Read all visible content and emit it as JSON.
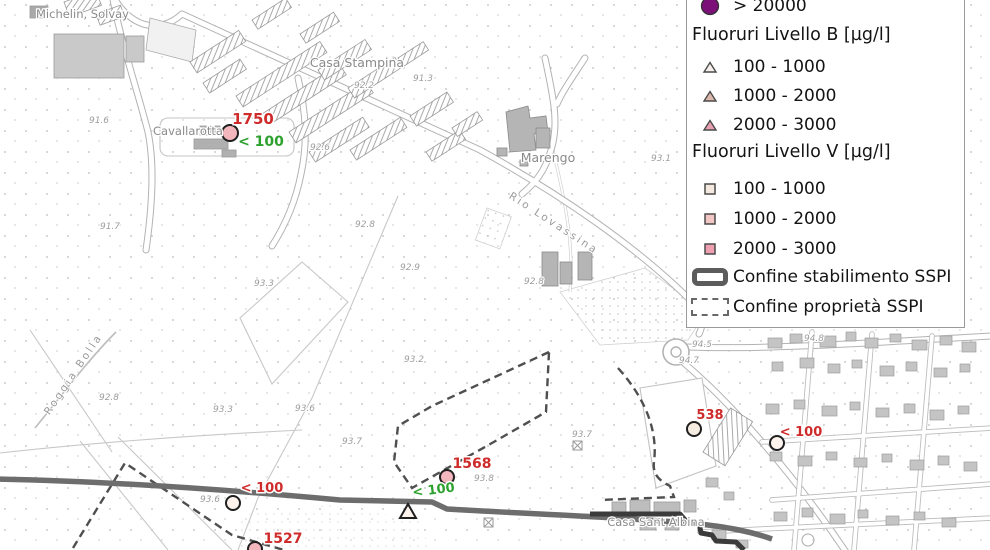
{
  "legend": {
    "top_item": {
      "label": "> 20000",
      "color": "#7a1078"
    },
    "section_b": {
      "title": "Fluoruri Livello B [µg/l]",
      "items": [
        {
          "label": "100 - 1000",
          "color": "#f5eeea"
        },
        {
          "label": "1000 - 2000",
          "color": "#dcb7ac"
        },
        {
          "label": "2000 - 3000",
          "color": "#e7a0b0"
        }
      ]
    },
    "section_v": {
      "title": "Fluoruri Livello V [µg/l]",
      "items": [
        {
          "label": "100 - 1000",
          "color": "#f5e8de"
        },
        {
          "label": "1000 - 2000",
          "color": "#f2c6c2"
        },
        {
          "label": "2000 - 3000",
          "color": "#efa0b0"
        }
      ]
    },
    "boundary_items": [
      {
        "label": "Confine stabilimento SSPI",
        "style": "solid"
      },
      {
        "label": "Confine proprietà SSPI",
        "style": "dashed"
      }
    ]
  },
  "map": {
    "colors": {
      "measurement_red": "#cf2b2b",
      "measurement_green": "#2da12d",
      "marker_pink": "#f2b6bc",
      "marker_light": "#fdf3ec",
      "marker_cream": "#f7ece2"
    },
    "place_labels": [
      {
        "text": "Michelin, Solvay"
      },
      {
        "text": "Casa Stampina"
      },
      {
        "text": "Cavallarotta"
      },
      {
        "text": "Marengo"
      },
      {
        "text": "Casa Sant Albina"
      },
      {
        "text": "Rio Lovassina"
      },
      {
        "text": "Roggia Bolla"
      }
    ],
    "elevations": [
      {
        "t": "91.6"
      },
      {
        "t": "92.2"
      },
      {
        "t": "91.3"
      },
      {
        "t": "92.6"
      },
      {
        "t": "91.7"
      },
      {
        "t": "92.8"
      },
      {
        "t": "92.9"
      },
      {
        "t": "93.3"
      },
      {
        "t": "92.8"
      },
      {
        "t": "93.1"
      },
      {
        "t": "93.2"
      },
      {
        "t": "93.3"
      },
      {
        "t": "93.6"
      },
      {
        "t": "92.8"
      },
      {
        "t": "93.7"
      },
      {
        "t": "93.6"
      },
      {
        "t": "93.7"
      },
      {
        "t": "93.8"
      },
      {
        "t": "94.5"
      },
      {
        "t": "94.7"
      },
      {
        "t": "94.8"
      }
    ],
    "measurements": [
      {
        "value": "1750",
        "color": "#cf2b2b"
      },
      {
        "value": "< 100",
        "color": "#2da12d"
      },
      {
        "value": "1568",
        "color": "#cf2b2b"
      },
      {
        "value": "< 100",
        "color": "#2da12d"
      },
      {
        "value": "< 100",
        "color": "#cf2b2b"
      },
      {
        "value": "1527",
        "color": "#cf2b2b"
      },
      {
        "value": "538",
        "color": "#cf2b2b"
      },
      {
        "value": "< 100",
        "color": "#cf2b2b"
      }
    ]
  }
}
